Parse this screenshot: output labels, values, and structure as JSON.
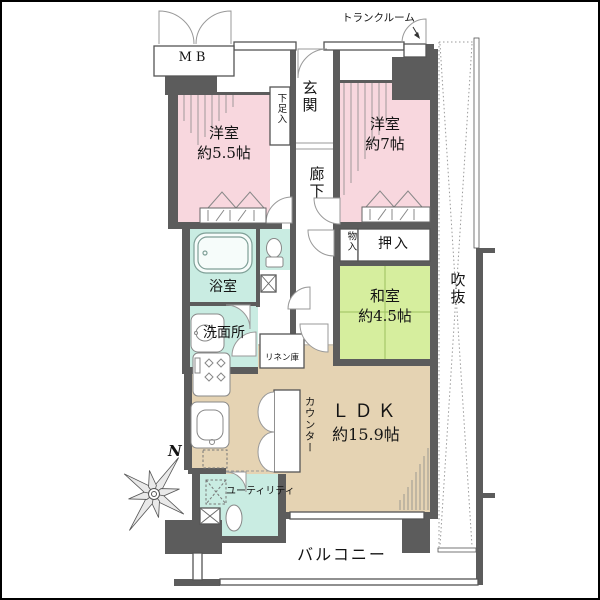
{
  "colors": {
    "wall": "#5c5c5c",
    "western_room": "#f8d7de",
    "wet_area": "#c9ece2",
    "japanese_room": "#d6ee9e",
    "ldk": "#e5d3b3",
    "tatami_line": "#9cc05f"
  },
  "rooms": {
    "mb": "MB",
    "trunk_room": "トランクルーム",
    "entrance": "玄関",
    "shoe_box": "下足入",
    "western1_name": "洋室",
    "western1_size": "約5.5帖",
    "western2_name": "洋室",
    "western2_size": "約7帖",
    "corridor": "廊下",
    "bathroom": "浴室",
    "washroom": "洗面所",
    "storage": "物入",
    "closet": "押入",
    "japanese_name": "和室",
    "japanese_size": "約4.5帖",
    "linen": "リネン庫",
    "counter": "カウンター",
    "ldk_name": "ＬＤＫ",
    "ldk_size": "約15.9帖",
    "utility": "ユーティリティ",
    "balcony": "バルコニー",
    "void": "吹抜",
    "compass_north": "N"
  }
}
